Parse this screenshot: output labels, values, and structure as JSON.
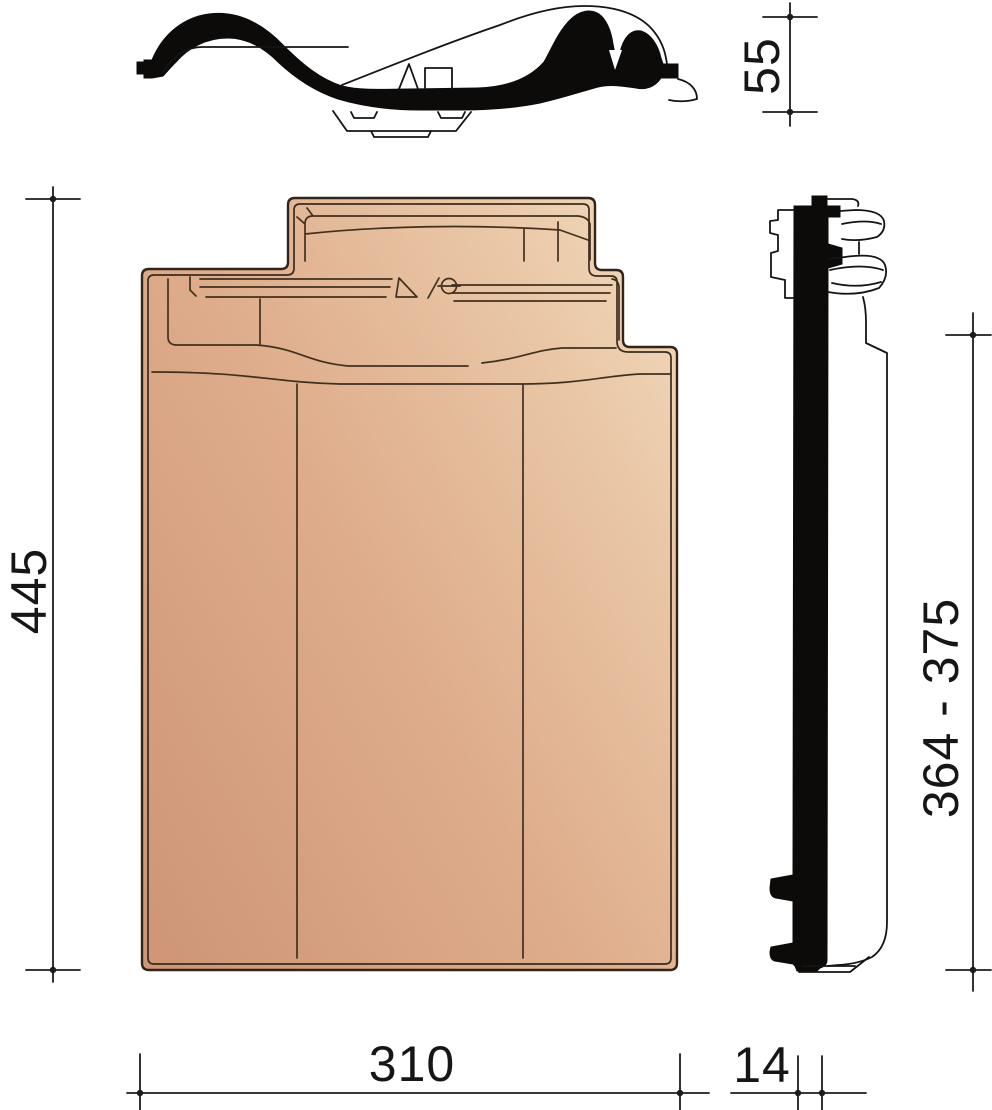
{
  "drawing": {
    "dimensions": {
      "profile_height": "55",
      "tile_length": "445",
      "hanging_length_range": "364 - 375",
      "tile_width": "310",
      "thickness": "14"
    },
    "colors": {
      "tile_dark": "#cf9778",
      "tile_mid": "#deac8b",
      "tile_light": "#e9c6a5",
      "tile_lightest": "#f0d8ba",
      "outline_brown": "#33241a",
      "profile_black": "#0c0b0a",
      "dimension_line": "#1c1c1c",
      "background": "#ffffff"
    }
  }
}
